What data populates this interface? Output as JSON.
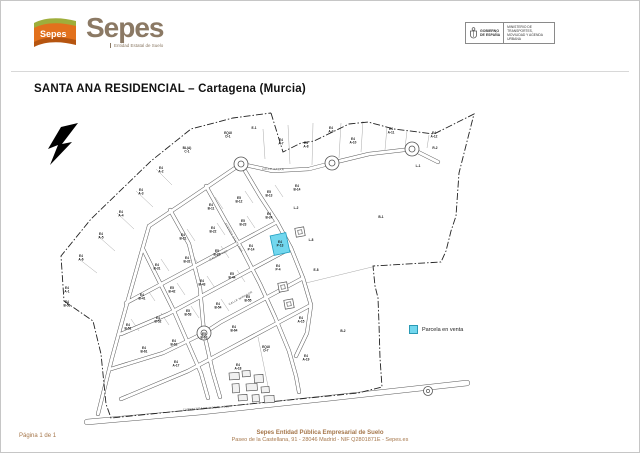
{
  "page": {
    "title": "SANTA ANA RESIDENCIAL – Cartagena (Murcia)",
    "page_label": "Página 1 de 1"
  },
  "logo": {
    "name": "Sepes",
    "flag_text": "Sepes",
    "tagline": "Entidad Estatal de Suelo",
    "brand_color": "#8b7964",
    "flag_orange": "#e2711d",
    "flag_green": "#9fae3b"
  },
  "gov": {
    "left_line1": "GOBIERNO",
    "left_line2": "DE ESPAÑA",
    "ministry": "MINISTERIO DE TRANSPORTES, MOVILIDAD Y AGENDA URBANA"
  },
  "legend": {
    "label": "Parcela en venta",
    "swatch_color": "#72d7ee",
    "swatch_border": "#2a9ab5"
  },
  "footer": {
    "line1": "Sepes Entidad Pública Empresarial de Suelo",
    "line2": "Paseo de la Castellana, 91 - 28046 Madrid - NIF Q2801871E - Sepes.es",
    "text_color": "#a5764a"
  },
  "map": {
    "colors": {
      "boundary": "#222222",
      "street_casing": "#555555",
      "street_fill": "#ffffff",
      "lot_line": "#a8a8a8",
      "label_text": "#1a1a1a",
      "street_text": "#444444",
      "building": "#444444"
    },
    "boundary": [
      [
        270,
        112
      ],
      [
        282,
        151
      ],
      [
        300,
        142
      ],
      [
        313,
        140
      ],
      [
        348,
        123
      ],
      [
        367,
        121
      ],
      [
        393,
        128
      ],
      [
        433,
        133
      ],
      [
        453,
        123
      ],
      [
        473,
        113
      ],
      [
        458,
        172
      ],
      [
        455,
        215
      ],
      [
        450,
        230
      ],
      [
        445,
        250
      ],
      [
        440,
        261
      ],
      [
        372,
        265
      ],
      [
        374,
        285
      ],
      [
        377,
        297
      ],
      [
        378,
        323
      ],
      [
        379,
        357
      ],
      [
        381,
        386
      ],
      [
        357,
        392
      ],
      [
        110,
        417
      ],
      [
        105,
        403
      ],
      [
        100,
        353
      ],
      [
        92,
        320
      ],
      [
        63,
        300
      ],
      [
        60,
        255
      ],
      [
        90,
        218
      ],
      [
        150,
        160
      ],
      [
        190,
        128
      ],
      [
        232,
        117
      ],
      [
        270,
        112
      ]
    ],
    "streets": [
      [
        [
          97,
          413
        ],
        [
          111,
          357
        ],
        [
          125,
          306
        ],
        [
          140,
          253
        ],
        [
          148,
          225
        ]
      ],
      [
        [
          148,
          225
        ],
        [
          178,
          205
        ],
        [
          212,
          182
        ],
        [
          240,
          163
        ]
      ],
      [
        [
          240,
          163
        ],
        [
          272,
          170
        ],
        [
          308,
          168
        ],
        [
          331,
          162
        ]
      ],
      [
        [
          331,
          162
        ],
        [
          368,
          153
        ],
        [
          411,
          148
        ]
      ],
      [
        [
          411,
          148
        ],
        [
          437,
          161
        ]
      ],
      [
        [
          240,
          163
        ],
        [
          259,
          195
        ],
        [
          276,
          221
        ],
        [
          290,
          247
        ],
        [
          302,
          277
        ],
        [
          310,
          304
        ],
        [
          306,
          332
        ],
        [
          295,
          355
        ]
      ],
      [
        [
          205,
          185
        ],
        [
          224,
          219
        ],
        [
          242,
          250
        ],
        [
          259,
          283
        ],
        [
          274,
          316
        ],
        [
          288,
          350
        ],
        [
          295,
          375
        ],
        [
          298,
          391
        ]
      ],
      [
        [
          169,
          209
        ],
        [
          188,
          243
        ],
        [
          199,
          287
        ],
        [
          203,
          332
        ],
        [
          212,
          372
        ],
        [
          219,
          396
        ]
      ],
      [
        [
          142,
          248
        ],
        [
          158,
          280
        ],
        [
          172,
          308
        ],
        [
          186,
          340
        ],
        [
          200,
          372
        ],
        [
          207,
          397
        ]
      ],
      [
        [
          276,
          221
        ],
        [
          235,
          243
        ],
        [
          194,
          265
        ],
        [
          153,
          287
        ],
        [
          125,
          302
        ]
      ],
      [
        [
          290,
          247
        ],
        [
          249,
          269
        ],
        [
          208,
          291
        ],
        [
          167,
          313
        ],
        [
          120,
          333
        ]
      ],
      [
        [
          302,
          277
        ],
        [
          261,
          299
        ],
        [
          220,
          321
        ],
        [
          203,
          332
        ],
        [
          162,
          352
        ],
        [
          110,
          368
        ]
      ],
      [
        [
          310,
          304
        ],
        [
          269,
          326
        ],
        [
          228,
          348
        ],
        [
          187,
          370
        ],
        [
          120,
          398
        ]
      ]
    ],
    "highway": [
      [
        86,
        421
      ],
      [
        200,
        411
      ],
      [
        330,
        397
      ],
      [
        466,
        382
      ]
    ],
    "roundabouts": [
      [
        240,
        163
      ],
      [
        331,
        162
      ],
      [
        411,
        148
      ],
      [
        203,
        332
      ]
    ],
    "mini_roundabouts": [
      [
        427,
        390
      ]
    ],
    "ct_squares": [
      [
        299,
        231
      ],
      [
        282,
        286
      ],
      [
        288,
        303
      ]
    ],
    "buildings": [
      [
        228,
        372,
        10,
        7
      ],
      [
        241,
        370,
        8,
        6
      ],
      [
        253,
        374,
        9,
        8
      ],
      [
        231,
        383,
        7,
        9
      ],
      [
        245,
        383,
        11,
        7
      ],
      [
        260,
        386,
        8,
        6
      ],
      [
        237,
        394,
        9,
        6
      ],
      [
        251,
        394,
        7,
        7
      ],
      [
        263,
        395,
        10,
        7
      ]
    ],
    "lot_lines": [
      [
        155,
        168,
        171,
        184
      ],
      [
        135,
        190,
        152,
        206
      ],
      [
        116,
        212,
        133,
        228
      ],
      [
        97,
        235,
        114,
        250
      ],
      [
        78,
        258,
        96,
        272
      ],
      [
        262,
        128,
        264,
        158
      ],
      [
        287,
        124,
        289,
        163
      ],
      [
        312,
        122,
        311,
        164
      ],
      [
        340,
        122,
        338,
        157
      ],
      [
        362,
        120,
        360,
        151
      ],
      [
        386,
        126,
        384,
        149
      ],
      [
        406,
        130,
        404,
        147
      ],
      [
        428,
        134,
        426,
        147
      ],
      [
        214,
        196,
        222,
        208
      ],
      [
        244,
        190,
        252,
        202
      ],
      [
        274,
        184,
        282,
        196
      ],
      [
        186,
        228,
        194,
        240
      ],
      [
        216,
        222,
        224,
        234
      ],
      [
        246,
        215,
        254,
        227
      ],
      [
        160,
        258,
        168,
        270
      ],
      [
        190,
        252,
        198,
        264
      ],
      [
        220,
        245,
        228,
        257
      ],
      [
        146,
        288,
        154,
        300
      ],
      [
        176,
        282,
        184,
        294
      ],
      [
        206,
        275,
        214,
        287
      ],
      [
        236,
        269,
        244,
        281
      ],
      [
        130,
        318,
        138,
        330
      ],
      [
        160,
        312,
        168,
        324
      ],
      [
        190,
        305,
        198,
        317
      ],
      [
        220,
        298,
        228,
        310
      ],
      [
        207,
        342,
        216,
        392
      ],
      [
        257,
        336,
        268,
        390
      ],
      [
        305,
        282,
        371,
        266
      ]
    ],
    "parcels": [
      [
        160,
        168,
        "E4",
        "A-2"
      ],
      [
        140,
        190,
        "E4",
        "A-3"
      ],
      [
        120,
        212,
        "E4",
        "A-4"
      ],
      [
        100,
        234,
        "E4",
        "A-5"
      ],
      [
        80,
        256,
        "E4",
        "A-6"
      ],
      [
        66,
        288,
        "E4",
        "A-1"
      ],
      [
        186,
        148,
        "BL(A)",
        "C-1"
      ],
      [
        227,
        133,
        "EQUI",
        "D-1"
      ],
      [
        253,
        128,
        "E-1",
        ""
      ],
      [
        280,
        140,
        "E4",
        "A-7"
      ],
      [
        305,
        143,
        "E4",
        "A-8"
      ],
      [
        330,
        128,
        "E4",
        "A-9"
      ],
      [
        352,
        139,
        "E4",
        "A-10"
      ],
      [
        390,
        129,
        "E4",
        "A-11"
      ],
      [
        433,
        133,
        "E4",
        "A-12"
      ],
      [
        434,
        148,
        "R-2",
        ""
      ],
      [
        417,
        166,
        "L-1",
        ""
      ],
      [
        380,
        217,
        "B-1",
        ""
      ],
      [
        342,
        331,
        "B-2",
        ""
      ],
      [
        210,
        205,
        "E4",
        "B-11"
      ],
      [
        238,
        198,
        "E5",
        "B-12"
      ],
      [
        268,
        192,
        "E5",
        "B-13"
      ],
      [
        296,
        186,
        "E4",
        "B-14"
      ],
      [
        182,
        235,
        "E4",
        "B-21"
      ],
      [
        212,
        228,
        "E4",
        "B-22"
      ],
      [
        242,
        221,
        "E5",
        "B-23"
      ],
      [
        268,
        214,
        "E4",
        "B-24"
      ],
      [
        295,
        208,
        "L-2",
        ""
      ],
      [
        156,
        265,
        "E4",
        "B-31"
      ],
      [
        186,
        258,
        "E4",
        "B-32"
      ],
      [
        216,
        251,
        "E5",
        "B-33"
      ],
      [
        250,
        246,
        "E4",
        "P-14"
      ],
      [
        277,
        266,
        "E4",
        "P-4"
      ],
      [
        141,
        295,
        "E4",
        "B-41"
      ],
      [
        171,
        288,
        "E5",
        "B-42"
      ],
      [
        201,
        281,
        "E4",
        "B-43"
      ],
      [
        231,
        274,
        "E5",
        "B-44"
      ],
      [
        127,
        325,
        "E4",
        "B-51"
      ],
      [
        157,
        318,
        "E4",
        "B-52"
      ],
      [
        187,
        311,
        "E5",
        "B-53"
      ],
      [
        217,
        304,
        "E4",
        "B-54"
      ],
      [
        247,
        297,
        "E5",
        "B-55"
      ],
      [
        143,
        348,
        "E4",
        "B-61"
      ],
      [
        173,
        341,
        "E4",
        "B-62"
      ],
      [
        203,
        334,
        "E5",
        "B-63"
      ],
      [
        233,
        327,
        "E4",
        "B-64"
      ],
      [
        300,
        318,
        "E4",
        "A-15"
      ],
      [
        265,
        347,
        "EQUI",
        "D-7"
      ],
      [
        175,
        362,
        "E4",
        "A-17"
      ],
      [
        237,
        365,
        "E4",
        "A-18"
      ],
      [
        305,
        356,
        "E4",
        "A-19"
      ],
      [
        310,
        240,
        "L-8",
        ""
      ],
      [
        315,
        270,
        "E-8",
        ""
      ],
      [
        66,
        302,
        "E4",
        "B-56"
      ]
    ],
    "highlight": {
      "x": 271,
      "y": 233,
      "w": 16,
      "h": 20,
      "rot": -12,
      "label1": "E4",
      "label2": "P-13",
      "fill": "#72d7ee",
      "stroke": "#1f9ec0"
    },
    "street_names": [
      {
        "text": "CALLE SALAR",
        "x": 272,
        "y": 169,
        "rot": 2
      },
      {
        "text": "CALLE POZA",
        "x": 218,
        "y": 255,
        "rot": -28
      },
      {
        "text": "CALLE MIRADOR",
        "x": 240,
        "y": 298,
        "rot": -28
      },
      {
        "text": "AVENIDA SANTA ANA",
        "x": 232,
        "y": 237,
        "rot": 60
      },
      {
        "text": "CARRETERA NACIONAL - 301",
        "x": 205,
        "y": 408,
        "rot": -4
      }
    ]
  }
}
